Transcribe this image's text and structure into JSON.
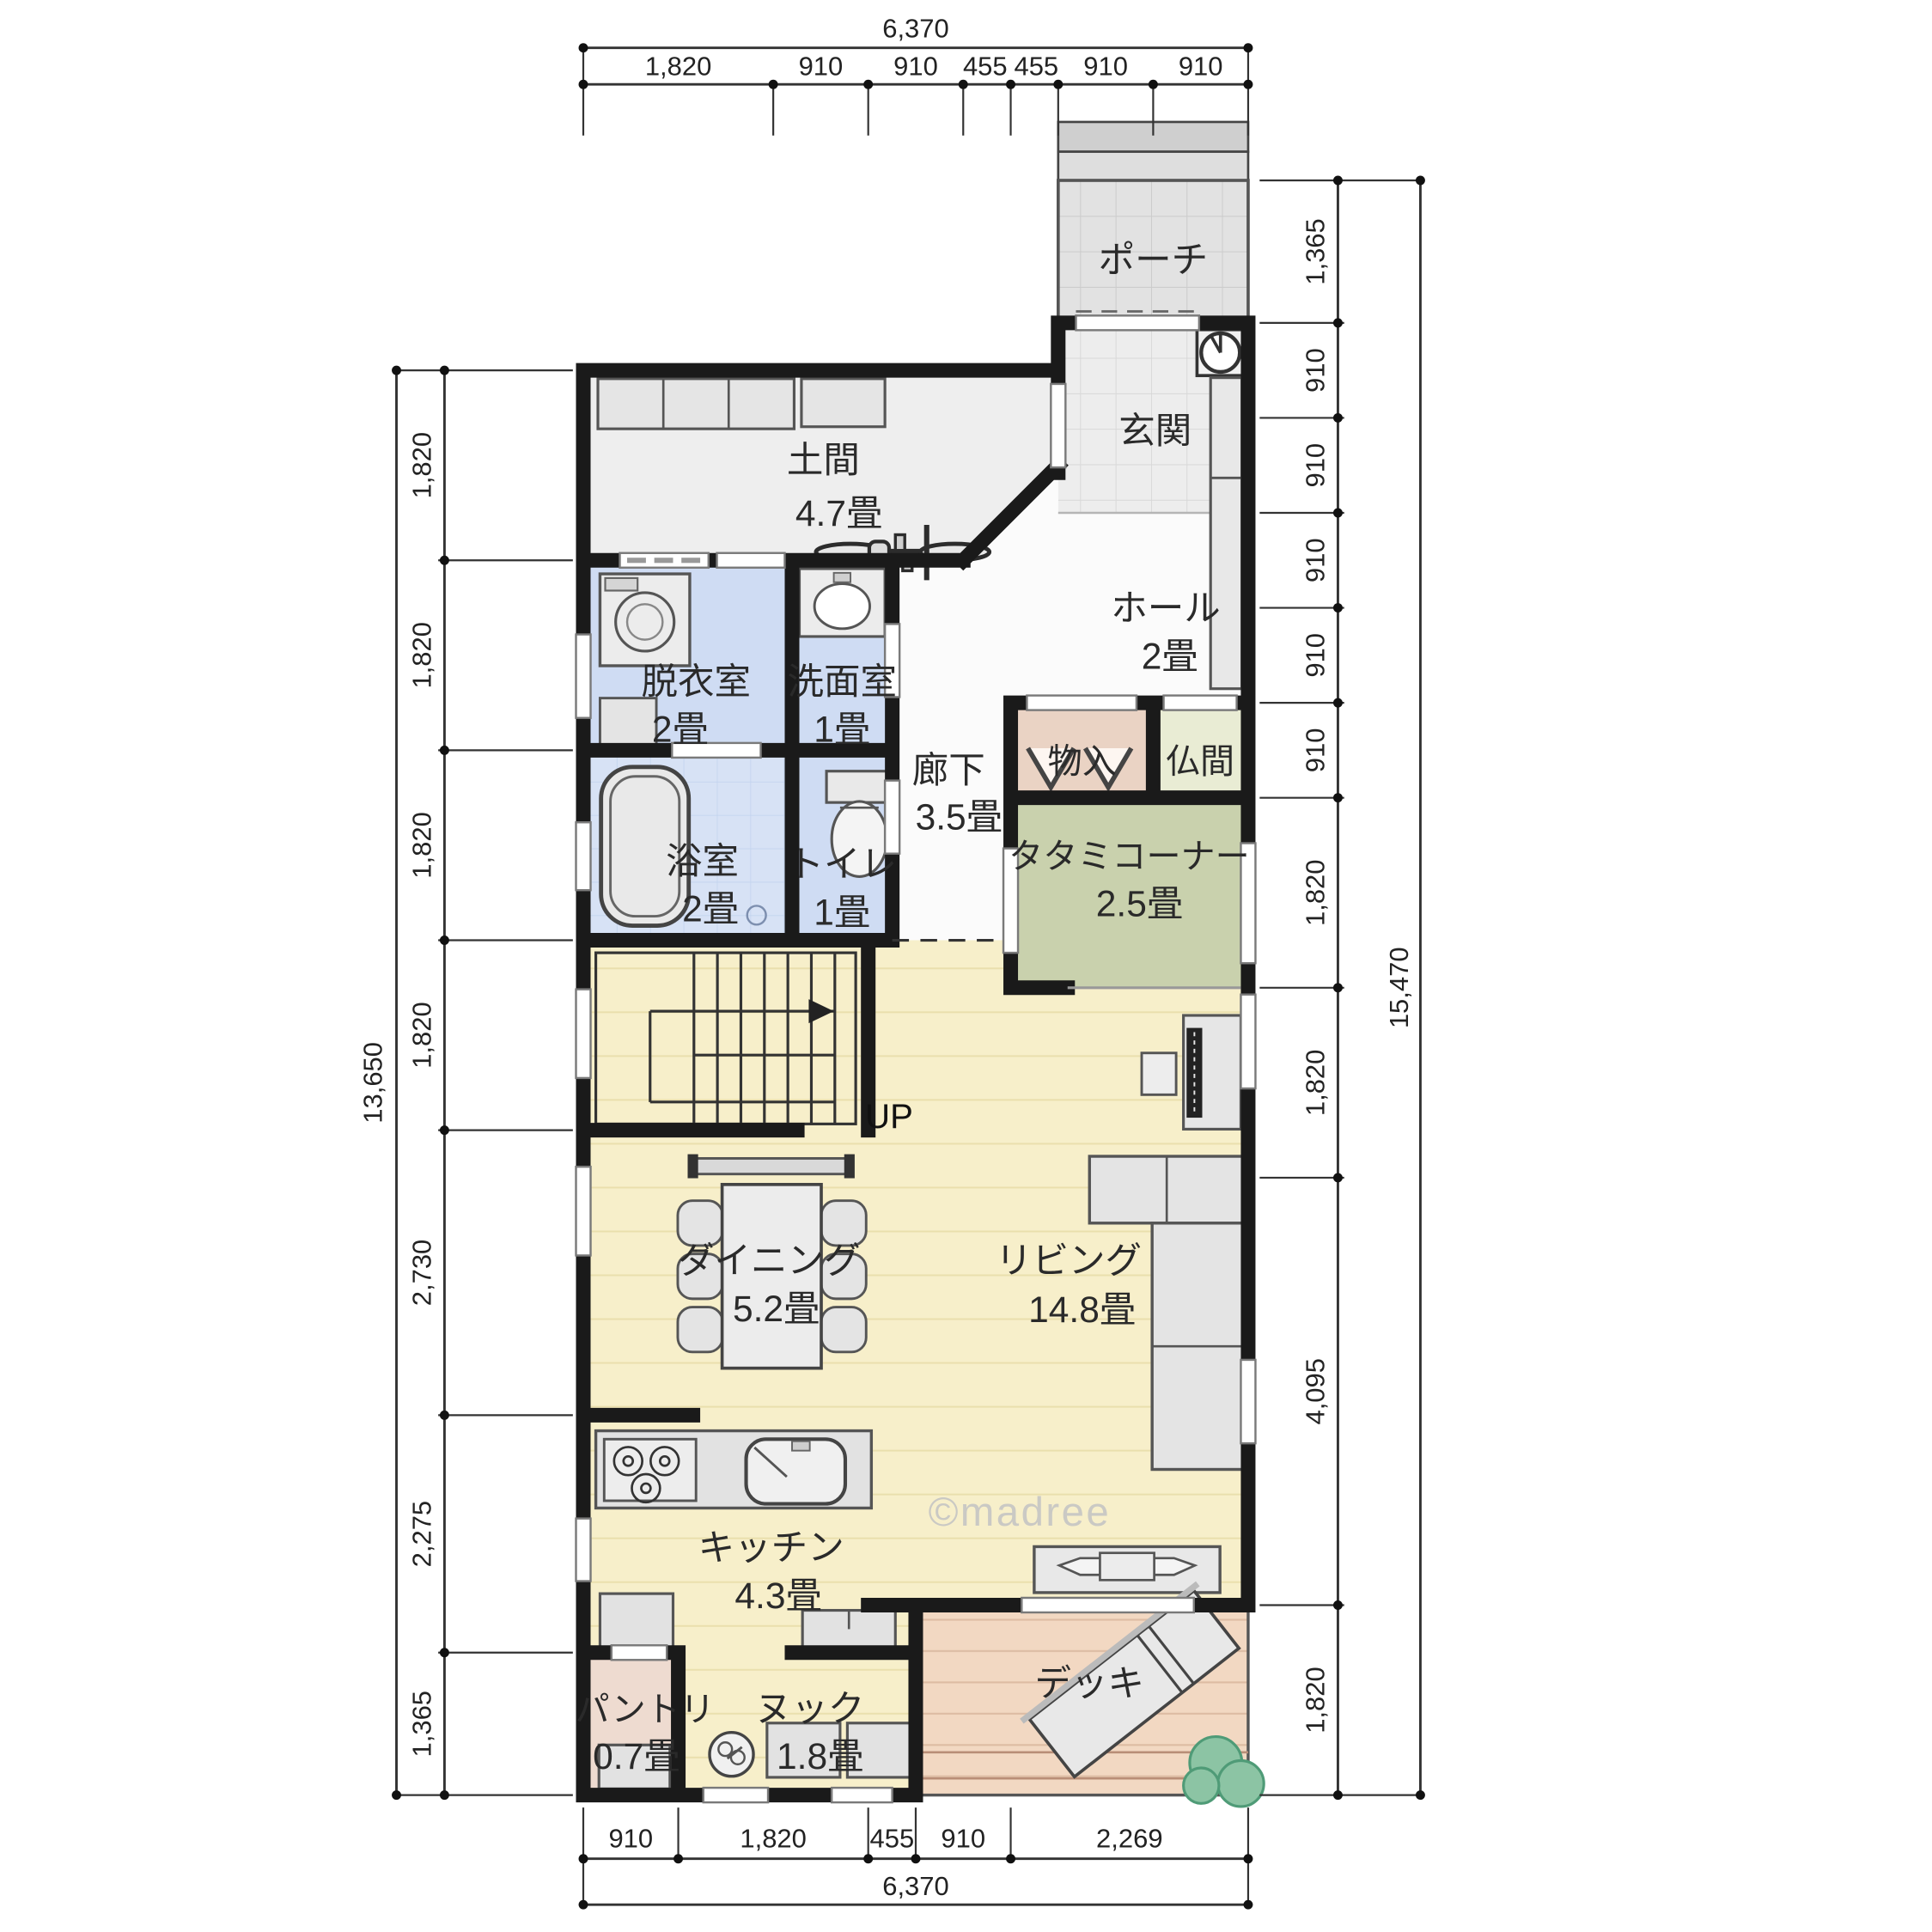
{
  "watermark": {
    "text": "©madree"
  },
  "stairs": {
    "up_label": "UP"
  },
  "rooms": [
    {
      "id": "porch",
      "label": "ポーチ"
    },
    {
      "id": "genkan",
      "label": "玄関"
    },
    {
      "id": "hall",
      "label": "ホール",
      "area": "2畳"
    },
    {
      "id": "doma",
      "label": "土間",
      "area": "4.7畳"
    },
    {
      "id": "datsui",
      "label": "脱衣室",
      "area": "2畳"
    },
    {
      "id": "senmen",
      "label": "洗面室",
      "area": "1畳"
    },
    {
      "id": "rouka",
      "label": "廊下",
      "area": "3.5畳"
    },
    {
      "id": "mononyu",
      "label": "物入"
    },
    {
      "id": "butsuma",
      "label": "仏間"
    },
    {
      "id": "tatami",
      "label": "タタミコーナー",
      "area": "2.5畳"
    },
    {
      "id": "bath",
      "label": "浴室",
      "area": "2畳"
    },
    {
      "id": "toilet",
      "label": "トイレ",
      "area": "1畳"
    },
    {
      "id": "dining",
      "label": "ダイニング",
      "area": "5.2畳"
    },
    {
      "id": "living",
      "label": "リビング",
      "area": "14.8畳"
    },
    {
      "id": "kitchen",
      "label": "キッチン",
      "area": "4.3畳"
    },
    {
      "id": "pantry",
      "label": "パントリ",
      "area": "0.7畳"
    },
    {
      "id": "nook",
      "label": "ヌック",
      "area": "1.8畳"
    },
    {
      "id": "deck",
      "label": "デッキ"
    }
  ],
  "dimensions": {
    "top": {
      "overall": "6,370",
      "segments": [
        "1,820",
        "910",
        "910",
        "455",
        "455",
        "910",
        "910"
      ]
    },
    "bottom": {
      "overall": "6,370",
      "segments": [
        "910",
        "1,820",
        "455",
        "910",
        "2,269"
      ]
    },
    "left": {
      "overall": "13,650",
      "segments": [
        "1,820",
        "1,820",
        "1,820",
        "1,820",
        "2,730",
        "2,275",
        "1,365"
      ]
    },
    "right": {
      "overall": "15,470",
      "segments": [
        "1,365",
        "910",
        "910",
        "910",
        "910",
        "910",
        "1,820",
        "1,820",
        "4,095",
        "1,820"
      ]
    }
  },
  "colors": {
    "wall": "#1a1a1a",
    "ldk_floor": "#f7efca",
    "tatami": "#c9d1ad",
    "wet_room": "#cfdcf3",
    "deck": "#f2d8c2",
    "closet": "#ead3c4",
    "butsuma": "#e9ecd4",
    "pantry": "#eedbd0",
    "porch_tile": "#e2e2e2",
    "watermark": "#c3c3c3"
  }
}
